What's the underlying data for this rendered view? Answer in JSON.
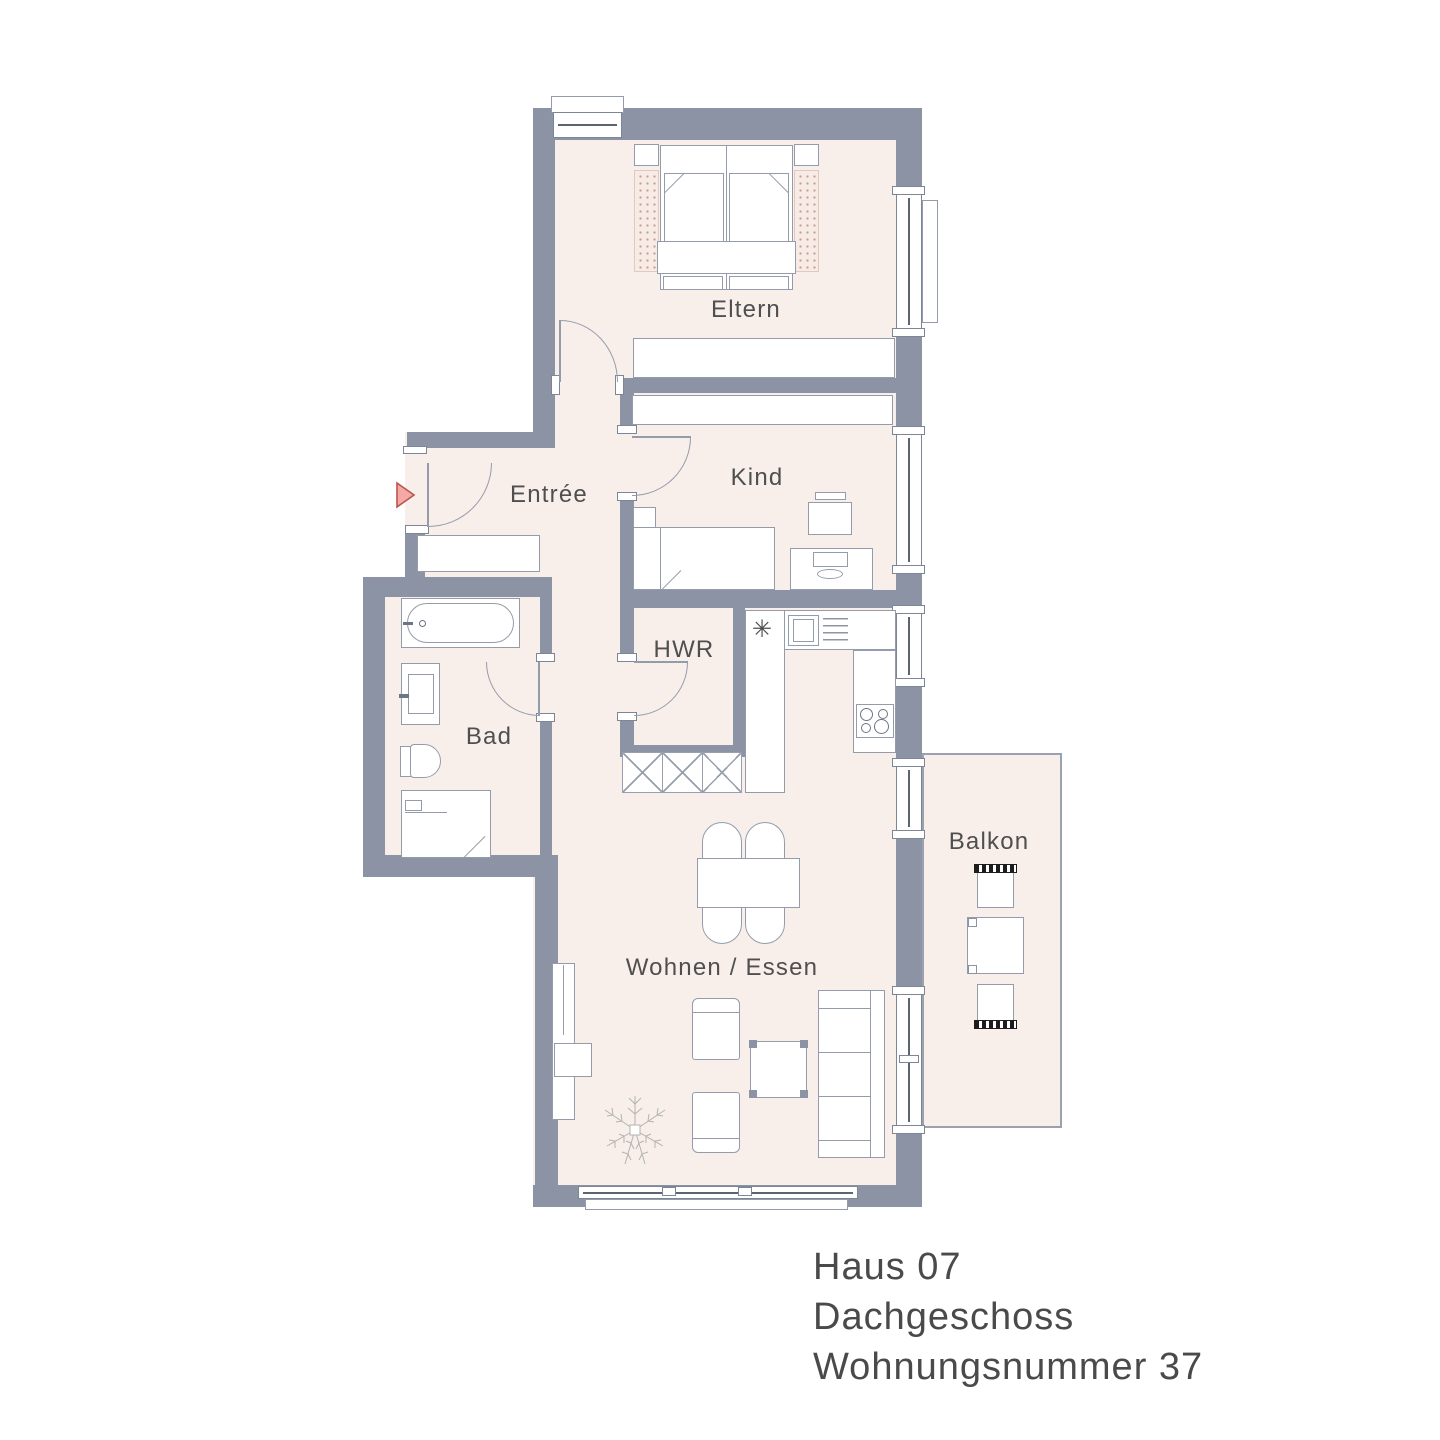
{
  "plan": {
    "type": "apartment-floor-plan",
    "rooms": {
      "eltern": "Eltern",
      "entree": "Entrée",
      "kind": "Kind",
      "hwr": "HWR",
      "bad": "Bad",
      "wohnen": "Wohnen / Essen",
      "balkon": "Balkon"
    },
    "title_block": {
      "house": "Haus 07",
      "floor": "Dachgeschoss",
      "apartment": "Wohnungsnummer 37"
    },
    "icons": {
      "sink": "✳",
      "entry_arrow": "right-pointing-triangle"
    },
    "colors": {
      "wall": "#8b93a4",
      "floor": "#f8efeb",
      "furniture_outline": "#949cab",
      "label_text": "#4f4f4f",
      "entry_arrow_fill": "#f4a9a4",
      "entry_arrow_stroke": "#b95450",
      "balcony_chair_hatch": "#1d1d1d"
    }
  }
}
